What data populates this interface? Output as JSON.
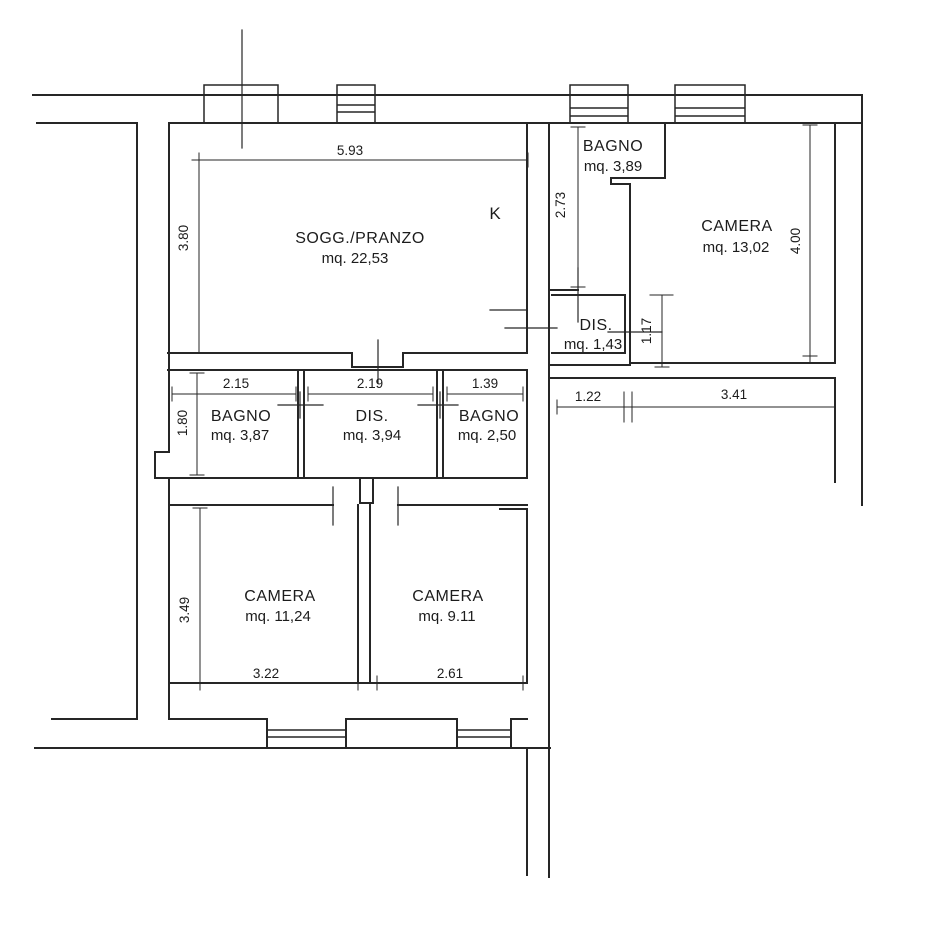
{
  "floorplan": {
    "kitchen_label": "K",
    "line_color": "#262626",
    "background": "#ffffff",
    "rooms": {
      "soggiorno": {
        "name": "SOGG./PRANZO",
        "area": "mq. 22,53"
      },
      "bagno_top": {
        "name": "BAGNO",
        "area": "mq. 3,89"
      },
      "camera_right": {
        "name": "CAMERA",
        "area": "mq. 13,02"
      },
      "dis_small": {
        "name": "DIS.",
        "area": "mq. 1,43"
      },
      "bagno_left": {
        "name": "BAGNO",
        "area": "mq. 3,87"
      },
      "dis_center": {
        "name": "DIS.",
        "area": "mq. 3,94"
      },
      "bagno_center": {
        "name": "BAGNO",
        "area": "mq. 2,50"
      },
      "camera_bottom_left": {
        "name": "CAMERA",
        "area": "mq. 11,24"
      },
      "camera_bottom_center": {
        "name": "CAMERA",
        "area": "mq. 9.11"
      }
    },
    "dimensions": {
      "sogg_width": "5.93",
      "sogg_height": "3.80",
      "bagno_top_height": "2.73",
      "camera_right_height": "4.00",
      "dis_small_height": "1.17",
      "hall_seg_left": "1.22",
      "hall_seg_right": "3.41",
      "bagno_left_width": "2.15",
      "dis_center_width": "2.19",
      "bagno_center_width": "1.39",
      "bagno_left_height": "1.80",
      "camera_bl_height": "3.49",
      "camera_bl_width": "3.22",
      "camera_bc_width": "2.61"
    }
  }
}
